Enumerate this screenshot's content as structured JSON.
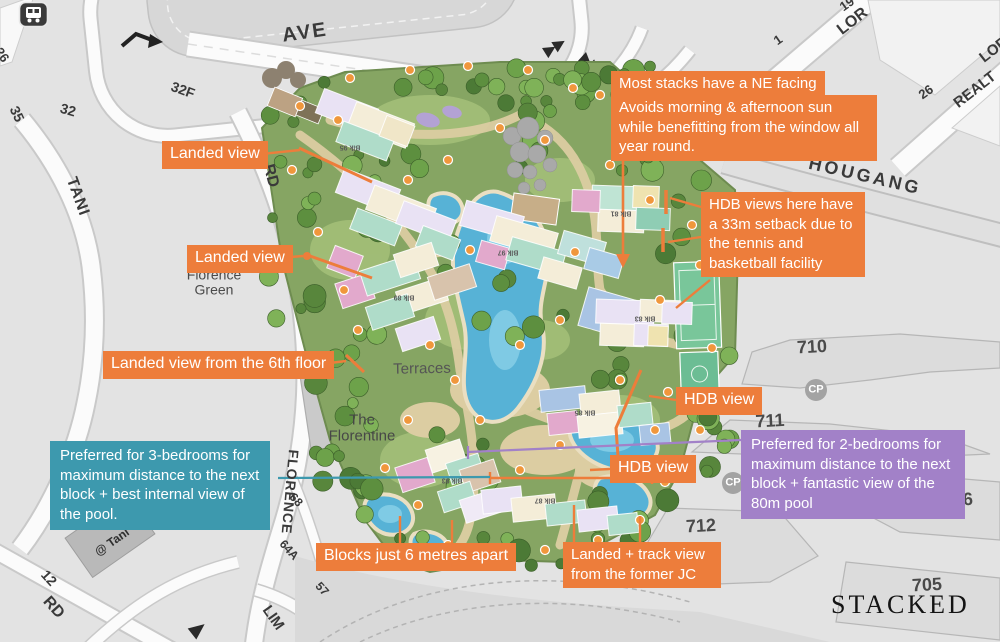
{
  "branding": {
    "logo_text": "STACKED"
  },
  "callouts": {
    "ne_facing_title": {
      "text": "Most stacks have a NE facing",
      "bg": "#ED7D3B"
    },
    "ne_facing_body": {
      "text": "Avoids morning & afternoon sun while benefitting from the window all year round.",
      "bg": "#ED7D3B"
    },
    "hdb_setback": {
      "text": "HDB views here have a 33m setback due to the tennis and basketball facility",
      "bg": "#ED7D3B"
    },
    "landed_view_1": {
      "text": "Landed view",
      "bg": "#ED7D3B"
    },
    "landed_view_2": {
      "text": "Landed view",
      "bg": "#ED7D3B"
    },
    "landed_view_6th": {
      "text": "Landed view from the 6th floor",
      "bg": "#ED7D3B"
    },
    "hdb_view_1": {
      "text": "HDB view",
      "bg": "#ED7D3B"
    },
    "hdb_view_2": {
      "text": "HDB view",
      "bg": "#ED7D3B"
    },
    "blocks_apart": {
      "text": "Blocks just 6 metres apart",
      "bg": "#ED7D3B"
    },
    "landed_track": {
      "text": "Landed + track view from the former JC",
      "bg": "#ED7D3B"
    },
    "preferred_3br": {
      "text": "Preferred for 3-bedrooms for maximum distance to the next block + best internal view of the pool.",
      "bg": "#3D99AE"
    },
    "preferred_2br": {
      "text": "Preferred for 2-bedrooms for maximum distance to the next block + fantastic view of the 80m pool",
      "bg": "#A281C8"
    }
  },
  "colors": {
    "annotation_orange": "#ED7D3B",
    "annotation_teal": "#3D99AE",
    "annotation_purple": "#A281C8",
    "pool_blue": "#57B2D6",
    "site_green": "#86A563"
  },
  "icons": {
    "bus_stop": "bus-icon",
    "parking": "cp-circle-icon",
    "direction_arrows": "road-arrow-icons"
  },
  "map": {
    "labels": [
      {
        "n": "road-ave",
        "t": "AVE",
        "x": 305,
        "y": 33,
        "r": -8,
        "s": 20,
        "w": 700,
        "c": "#3A3A3A",
        "ls": 2
      },
      {
        "n": "road-tani",
        "t": "TANI",
        "x": 77,
        "y": 197,
        "r": 70,
        "s": 16,
        "w": 700,
        "c": "#3A3A3A",
        "ls": 1
      },
      {
        "n": "road-rd-top",
        "t": "RD",
        "x": 270,
        "y": 176,
        "r": 75,
        "s": 16,
        "w": 700,
        "c": "#3A3A3A"
      },
      {
        "n": "road-florence",
        "t": "FLORENCE",
        "x": 290,
        "y": 492,
        "r": 95,
        "s": 14,
        "w": 700,
        "c": "#3A3A3A",
        "ls": 1
      },
      {
        "n": "road-lim",
        "t": "LIM",
        "x": 273,
        "y": 618,
        "r": 55,
        "s": 15,
        "w": 700,
        "c": "#3A3A3A"
      },
      {
        "n": "road-rd-bottom",
        "t": "RD",
        "x": 53,
        "y": 608,
        "r": 48,
        "s": 16,
        "w": 700,
        "c": "#3A3A3A"
      },
      {
        "n": "road-hougang",
        "t": "HOUGANG",
        "x": 865,
        "y": 176,
        "r": 13,
        "s": 18,
        "w": 700,
        "c": "#3A3A3A",
        "ls": 3
      },
      {
        "n": "road-lor-1",
        "t": "LOR",
        "x": 853,
        "y": 22,
        "r": -38,
        "s": 16,
        "w": 700,
        "c": "#3A3A3A"
      },
      {
        "n": "road-lor-2",
        "t": "LOR",
        "x": 994,
        "y": 50,
        "r": -38,
        "s": 15,
        "w": 700,
        "c": "#3A3A3A"
      },
      {
        "n": "road-realt",
        "t": "REALT",
        "x": 975,
        "y": 90,
        "r": -38,
        "s": 15,
        "w": 700,
        "c": "#3A3A3A"
      },
      {
        "n": "lot-1",
        "t": "1",
        "x": 778,
        "y": 40,
        "r": -35,
        "s": 13,
        "w": 700,
        "c": "#3A3A3A"
      },
      {
        "n": "lot-19",
        "t": "19",
        "x": 847,
        "y": 4,
        "r": -35,
        "s": 13,
        "w": 700,
        "c": "#3A3A3A"
      },
      {
        "n": "lot-26",
        "t": "26",
        "x": 926,
        "y": 92,
        "r": -35,
        "s": 13,
        "w": 700,
        "c": "#3A3A3A"
      },
      {
        "n": "lot-26b",
        "t": "26",
        "x": 2,
        "y": 55,
        "r": 55,
        "s": 13,
        "w": 700,
        "c": "#3A3A3A"
      },
      {
        "n": "lot-32f",
        "t": "32F",
        "x": 183,
        "y": 90,
        "r": 20,
        "s": 14,
        "w": 700,
        "c": "#3A3A3A"
      },
      {
        "n": "lot-32",
        "t": "32",
        "x": 68,
        "y": 110,
        "r": 16,
        "s": 14,
        "w": 700,
        "c": "#3A3A3A"
      },
      {
        "n": "lot-35",
        "t": "35",
        "x": 17,
        "y": 114,
        "r": 65,
        "s": 14,
        "w": 700,
        "c": "#3A3A3A"
      },
      {
        "n": "lot-12",
        "t": "12",
        "x": 49,
        "y": 578,
        "r": 48,
        "s": 14,
        "w": 700,
        "c": "#3A3A3A"
      },
      {
        "n": "lot-68",
        "t": "68",
        "x": 296,
        "y": 500,
        "r": 48,
        "s": 12,
        "w": 700,
        "c": "#3A3A3A"
      },
      {
        "n": "lot-64a",
        "t": "64A",
        "x": 289,
        "y": 550,
        "r": 48,
        "s": 12,
        "w": 700,
        "c": "#3A3A3A"
      },
      {
        "n": "lot-57",
        "t": "57",
        "x": 322,
        "y": 589,
        "r": 48,
        "s": 12,
        "w": 700,
        "c": "#3A3A3A"
      },
      {
        "n": "hdb-710",
        "t": "710",
        "x": 812,
        "y": 347,
        "r": -3,
        "s": 18,
        "w": 700,
        "c": "#4A4A4A"
      },
      {
        "n": "hdb-711",
        "t": "711",
        "x": 770,
        "y": 421,
        "r": -3,
        "s": 18,
        "w": 700,
        "c": "#4A4A4A"
      },
      {
        "n": "hdb-712",
        "t": "712",
        "x": 701,
        "y": 526,
        "r": -3,
        "s": 18,
        "w": 700,
        "c": "#4A4A4A"
      },
      {
        "n": "hdb-706",
        "t": "706",
        "x": 958,
        "y": 500,
        "r": -3,
        "s": 18,
        "w": 700,
        "c": "#4A4A4A"
      },
      {
        "n": "hdb-705",
        "t": "705",
        "x": 927,
        "y": 585,
        "r": -3,
        "s": 18,
        "w": 700,
        "c": "#4A4A4A"
      },
      {
        "n": "area-florence-green",
        "t": "Florence\nGreen",
        "x": 214,
        "y": 282,
        "r": 0,
        "s": 14,
        "w": 400,
        "c": "#4A4A4A"
      },
      {
        "n": "area-terraces",
        "t": "Terraces",
        "x": 422,
        "y": 369,
        "r": -1,
        "s": 15,
        "w": 400,
        "c": "#555555"
      },
      {
        "n": "area-the-florentine",
        "t": "The\nFlorentine",
        "x": 362,
        "y": 428,
        "r": 0,
        "s": 15,
        "w": 400,
        "c": "#474747"
      },
      {
        "n": "area-tani-building",
        "t": "@ Tani",
        "x": 112,
        "y": 542,
        "r": -35,
        "s": 12,
        "w": 700,
        "c": "#2F2F2F"
      },
      {
        "n": "parking-cp-1",
        "t": "CP",
        "x": 816,
        "y": 390,
        "r": 0,
        "s": 11,
        "w": 700,
        "c": "#FFFFFF"
      },
      {
        "n": "parking-cp-2",
        "t": "CP",
        "x": 733,
        "y": 483,
        "r": 0,
        "s": 11,
        "w": 700,
        "c": "#FFFFFF"
      }
    ]
  },
  "site": {
    "block_labels": [
      "Blk 95",
      "Blk 97",
      "Blk 81",
      "Blk 83",
      "Blk 89",
      "Blk 85",
      "Blk 87",
      "Blk 93"
    ]
  }
}
